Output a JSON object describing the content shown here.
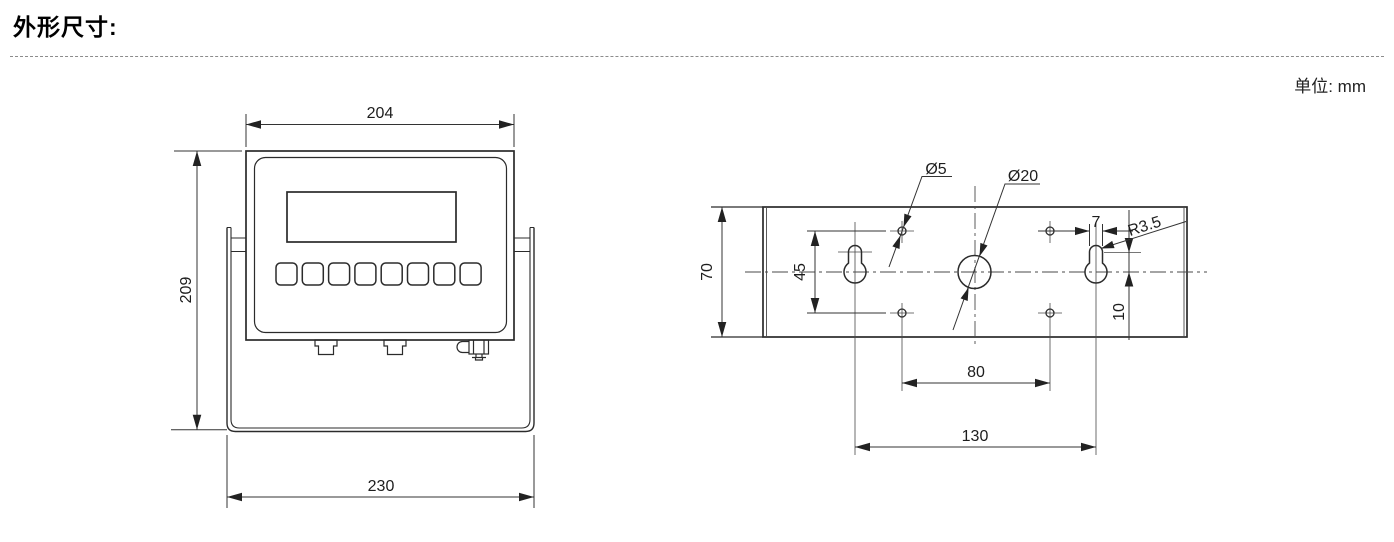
{
  "header": {
    "title": "外形尺寸:",
    "unit_label": "单位: mm"
  },
  "front_view": {
    "dim_top_width": "204",
    "dim_height": "209",
    "dim_bottom_width": "230"
  },
  "rear_view": {
    "dim_plate_height": "70",
    "dim_hole_vertical_spacing": "45",
    "dim_hole_horizontal_spacing": "80",
    "dim_keyhole_spacing": "130",
    "dim_slot_width": "7",
    "dim_slot_center_offset": "10",
    "label_small_hole_diameter": "Ø5",
    "label_center_hole_diameter": "Ø20",
    "label_slot_radius": "R3.5"
  }
}
